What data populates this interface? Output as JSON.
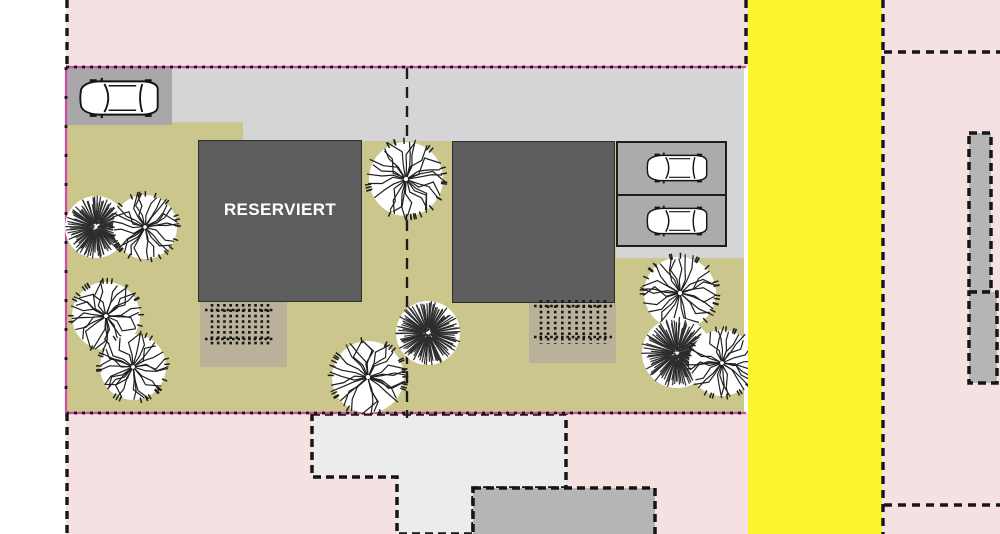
{
  "plan": {
    "reserved_label": "RESERVIERT",
    "colors": {
      "parcel_pink": "#f5e1e2",
      "margin_white": "#ffffff",
      "road_yellow": "#fcf42c",
      "plot_olive": "#cbc68c",
      "driveway_gray": "#d5d5d7",
      "parking_pad_gray": "#a8a8aa",
      "stall_gray": "#ababad",
      "building_dark_gray": "#5d5d5d",
      "terrace_tan": "#b9b199",
      "neighbor_light_gray": "#ececec",
      "neighbor_mid_gray": "#b5b5b5",
      "boundary_magenta": "#cf4aa0",
      "line_black": "#161616"
    },
    "plot_boundary": {
      "top": {
        "x1": 66,
        "y1": 67,
        "x2": 746,
        "y2": 67
      },
      "bottom": {
        "x1": 66,
        "y1": 413,
        "x2": 746,
        "y2": 413
      },
      "left": {
        "x1": 66,
        "y1": 67,
        "x2": 66,
        "y2": 413
      }
    },
    "divider_line": {
      "x": 407,
      "y1": 68,
      "y2": 418
    },
    "parcel_dashed_lines": [
      {
        "x1": 67,
        "y1": 0,
        "x2": 67,
        "y2": 67
      },
      {
        "x1": 67,
        "y1": 413,
        "x2": 67,
        "y2": 534
      },
      {
        "x1": 746,
        "y1": 0,
        "x2": 746,
        "y2": 68
      },
      {
        "x1": 883,
        "y1": 0,
        "x2": 883,
        "y2": 534
      },
      {
        "x1": 884,
        "y1": 52,
        "x2": 1000,
        "y2": 52
      },
      {
        "x1": 884,
        "y1": 505,
        "x2": 1000,
        "y2": 505
      }
    ],
    "neighbor_buildings": [
      {
        "name": "neighbor-building-south-light",
        "points": "312,414 566,414 566,488 473,488 473,534 397,534 397,477 312,477",
        "fill_key": "neighbor_light_gray"
      },
      {
        "name": "neighbor-building-south-mid",
        "points": "473,488 655,488 655,536 473,536",
        "fill_key": "neighbor_mid_gray"
      },
      {
        "name": "neighbor-building-east-upper",
        "points": "969,133 991,133 991,292 969,292",
        "fill_key": "neighbor_mid_gray"
      },
      {
        "name": "neighbor-building-east-lower",
        "points": "969,292 997,292 997,383 969,383",
        "fill_key": "neighbor_mid_gray"
      }
    ],
    "trees": [
      {
        "x": 96,
        "y": 227,
        "r": 31,
        "type": "conifer"
      },
      {
        "x": 145,
        "y": 227,
        "r": 32,
        "type": "broadleaf"
      },
      {
        "x": 106,
        "y": 316,
        "r": 34,
        "type": "broadleaf"
      },
      {
        "x": 133,
        "y": 367,
        "r": 33,
        "type": "broadleaf"
      },
      {
        "x": 406,
        "y": 179,
        "r": 37,
        "type": "broadleaf"
      },
      {
        "x": 428,
        "y": 333,
        "r": 32,
        "type": "conifer"
      },
      {
        "x": 368,
        "y": 377,
        "r": 36,
        "type": "broadleaf"
      },
      {
        "x": 680,
        "y": 293,
        "r": 36,
        "type": "broadleaf"
      },
      {
        "x": 677,
        "y": 353,
        "r": 35,
        "type": "conifer"
      },
      {
        "x": 722,
        "y": 363,
        "r": 33,
        "type": "broadleaf"
      }
    ],
    "cars": [
      {
        "x": 76,
        "y": 77,
        "w": 86,
        "h": 42
      },
      {
        "x": 644,
        "y": 152,
        "w": 66,
        "h": 32
      },
      {
        "x": 644,
        "y": 205,
        "w": 66,
        "h": 32
      }
    ],
    "railings": [
      {
        "x1": 205,
        "x2": 275,
        "yTop": 310,
        "yBot": 339,
        "posts": 10,
        "postTop": 304,
        "postBot": 346
      },
      {
        "x1": 534,
        "x2": 612,
        "yTop": 306,
        "yBot": 337,
        "posts": 10,
        "postTop": 300,
        "postBot": 344
      }
    ]
  }
}
